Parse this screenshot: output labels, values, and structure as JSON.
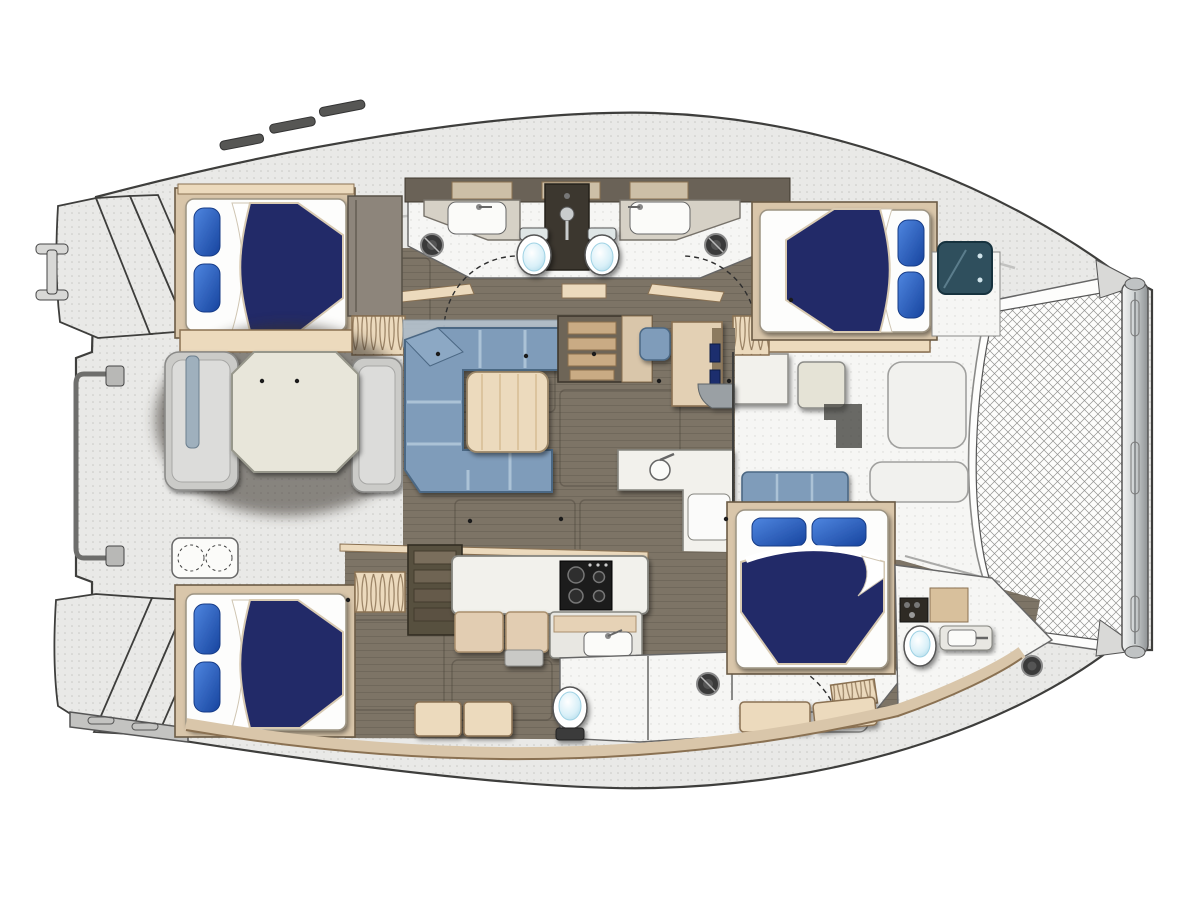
{
  "title": "Catamaran yacht interior floor plan, top view",
  "inventory": {
    "hulls": 2,
    "double-berths": 4,
    "pillows-per-berth": 2,
    "toilets": 4,
    "sinks": 5,
    "showers": 2,
    "stove-burners": 4,
    "cockpit-table": 1,
    "salon-table": 1,
    "nav-desk": 1,
    "trampoline": 1,
    "companionway-stairs": 2,
    "transom-steps": 2
  },
  "colors": {
    "outline": "#3e3e3c",
    "deck": "#e9e9e7",
    "deckDot": "#9d9d9a",
    "hullBand": "#f6f6f4",
    "floor": "#7d7466",
    "floorLine": "#3f3a30",
    "woodTan": "#d9c6aa",
    "woodEdge": "#8a7152",
    "lightWood": "#ecdabd",
    "darkBand": "#6a6257",
    "furnWhite": "#f2f1ec",
    "furnEdge": "#85857f",
    "counterGray": "#d6d1c6",
    "navy": "#232a68",
    "pillowLight": "#4f86e0",
    "pillowDeep": "#17449e",
    "sheetWhite": "#ffffff",
    "sofa": "#7f9cba",
    "sofaLight": "#abc2d6",
    "sofaEdge": "#4c6884",
    "benchGray": "#cbcbc8",
    "cockpitShadow": "#37332b",
    "glass": "#b6c4d1",
    "teal": "#2f4f5d",
    "stove": "#1a1a1a",
    "cyan": "#d9f0f8",
    "cyanDeep": "#9fd2e4",
    "trampLine": "#949492",
    "metal": "#ccd0d1",
    "metalDark": "#8e9294",
    "stairTread": "#c9ab84",
    "stairDark": "#57503f",
    "dash": "#2e2e2e"
  }
}
